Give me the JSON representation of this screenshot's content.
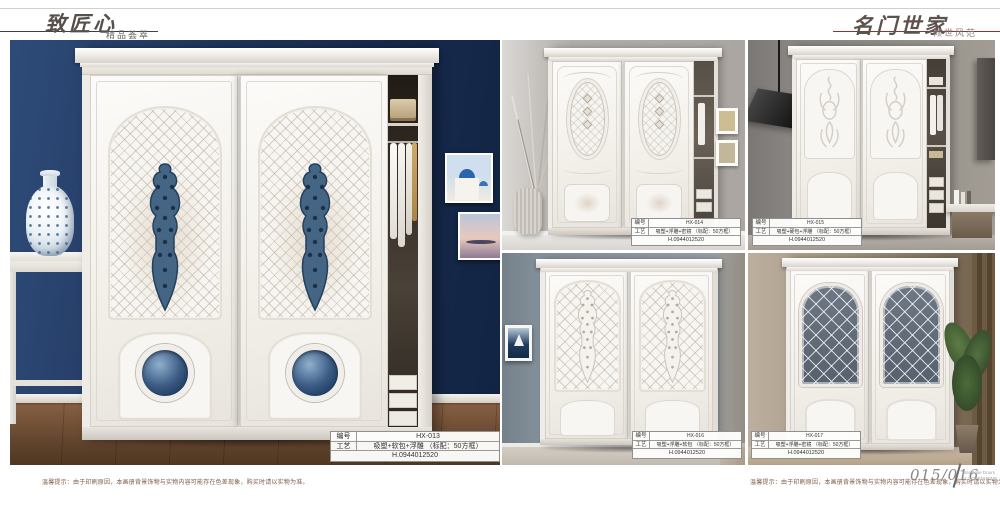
{
  "header": {
    "left_title": "致匠心",
    "left_subtitle": "精品荟萃",
    "right_title": "名门世家",
    "right_subtitle": "倾世风范"
  },
  "labels": {
    "code": "编号",
    "craft": "工艺"
  },
  "products": [
    {
      "code": "HX-013",
      "craft": "吸塑+软包+浮雕 （标配：50方框）",
      "serial": "H.0944012520"
    },
    {
      "code": "HX-014",
      "craft": "吸塑+浮雕+密镜 （标配：50方框）",
      "serial": "H.0944012520"
    },
    {
      "code": "HX-015",
      "craft": "吸塑+硬包+浮雕 （标配：50方框）",
      "serial": "H.0944012520"
    },
    {
      "code": "HX-016",
      "craft": "吸塑+浮雕+软包 （标配：50方框）",
      "serial": "H.0944012520"
    },
    {
      "code": "HX-017",
      "craft": "吸塑+浮雕+密镜 （标配：50方框）",
      "serial": "H.0944012520"
    }
  ],
  "footer": {
    "disclaimer": "温馨提示：由于印刷原因，本画册背景饰物与实物内容可能存在色差现象，购买时请以实物为准。",
    "page_number": "015/016",
    "brand_line1": "Wardrobe Doors",
    "brand_line2": "ALL CHENHONG"
  },
  "colors": {
    "navy_wall": "#1d3357",
    "red_rule": "#8a3434",
    "ornament_blue": "#456585",
    "wood_floor": "#6b4a33"
  }
}
